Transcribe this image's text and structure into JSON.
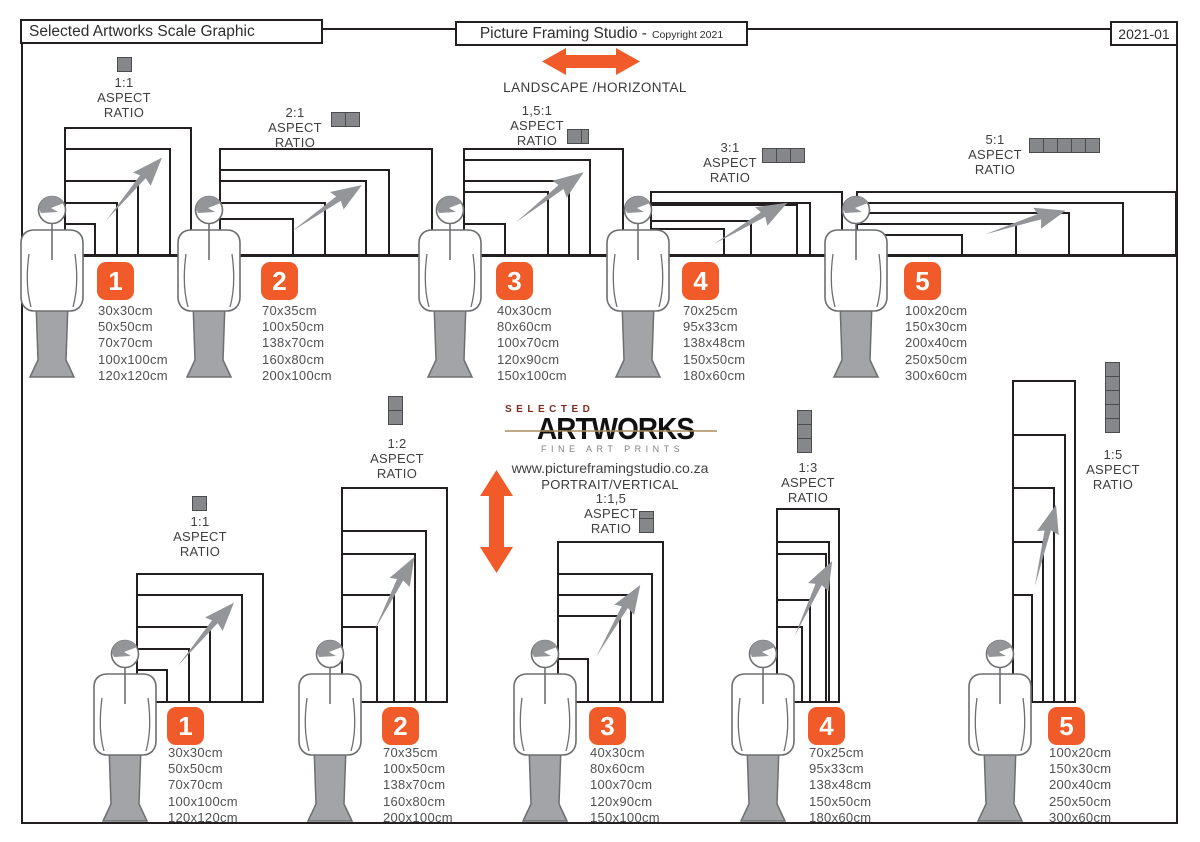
{
  "header": {
    "title": "Selected Artworks Scale Graphic",
    "studio_name": "Picture Framing Studio -",
    "copyright": "Copyright 2021",
    "doc_code": "2021-01"
  },
  "logo": {
    "top": "SELECTED",
    "main": "ARTWORKS",
    "tagline": "FINE ART PRINTS",
    "url": "www.pictureframingstudio.co.za"
  },
  "labels": {
    "aspect": "ASPECT",
    "ratio": "RATIO"
  },
  "colors": {
    "accent": "#F15A29",
    "icon_gray": "#85878b",
    "line": "#231F20",
    "text": "#4f5052"
  },
  "sections": {
    "landscape": {
      "label": "LANDSCAPE /HORIZONTAL",
      "groups": [
        {
          "number": "1",
          "ratio": "1:1",
          "sizes": [
            "30x30cm",
            "50x50cm",
            "70x70cm",
            "100x100cm",
            "120x120cm"
          ]
        },
        {
          "number": "2",
          "ratio": "2:1",
          "sizes": [
            "70x35cm",
            "100x50cm",
            "138x70cm",
            "160x80cm",
            "200x100cm"
          ]
        },
        {
          "number": "3",
          "ratio": "1,5:1",
          "sizes": [
            "40x30cm",
            "80x60cm",
            "100x70cm",
            "120x90cm",
            "150x100cm"
          ]
        },
        {
          "number": "4",
          "ratio": "3:1",
          "sizes": [
            "70x25cm",
            "95x33cm",
            "138x48cm",
            "150x50cm",
            "180x60cm"
          ]
        },
        {
          "number": "5",
          "ratio": "5:1",
          "sizes": [
            "100x20cm",
            "150x30cm",
            "200x40cm",
            "250x50cm",
            "300x60cm"
          ]
        }
      ]
    },
    "portrait": {
      "label": "PORTRAIT/VERTICAL",
      "groups": [
        {
          "number": "1",
          "ratio": "1:1",
          "sizes": [
            "30x30cm",
            "50x50cm",
            "70x70cm",
            "100x100cm",
            "120x120cm"
          ]
        },
        {
          "number": "2",
          "ratio": "1:2",
          "sizes": [
            "70x35cm",
            "100x50cm",
            "138x70cm",
            "160x80cm",
            "200x100cm"
          ]
        },
        {
          "number": "3",
          "ratio": "1:1,5",
          "sizes": [
            "40x30cm",
            "80x60cm",
            "100x70cm",
            "120x90cm",
            "150x100cm"
          ]
        },
        {
          "number": "4",
          "ratio": "1:3",
          "sizes": [
            "70x25cm",
            "95x33cm",
            "138x48cm",
            "150x50cm",
            "180x60cm"
          ]
        },
        {
          "number": "5",
          "ratio": "1:5",
          "sizes": [
            "100x20cm",
            "150x30cm",
            "200x40cm",
            "250x50cm",
            "300x60cm"
          ]
        }
      ]
    }
  }
}
